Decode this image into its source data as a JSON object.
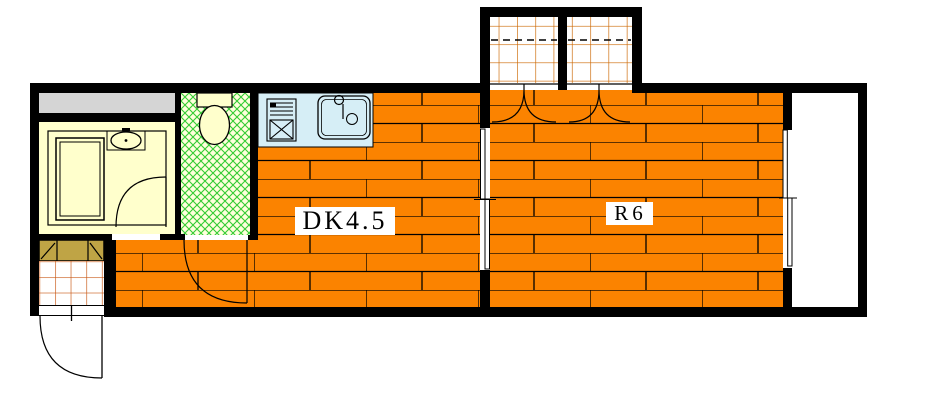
{
  "floorplan": {
    "rooms": {
      "dk": {
        "label": "DK4.5"
      },
      "r": {
        "label": "R6"
      }
    },
    "colors": {
      "floor_orange": "#FB8300",
      "wall_black": "#000000",
      "bath_cream": "#FFFFCC",
      "toilet_floor_cream": "#FFFFDC",
      "toilet_hatch_green": "#33CC33",
      "kitchen_blue": "#D6EEF6",
      "closet_grid_orange": "#CC6600",
      "genkan_grid_orange": "#C85510",
      "cabinet_tan": "#BFA445",
      "shelf_gray": "#D5D5D5"
    },
    "fixtures": [
      "bathtub",
      "washbasin",
      "toilet",
      "stove",
      "kitchen-sink",
      "shoe-cabinet",
      "closet",
      "closet",
      "sliding-door",
      "balcony-window",
      "entrance-door",
      "balcony"
    ]
  }
}
